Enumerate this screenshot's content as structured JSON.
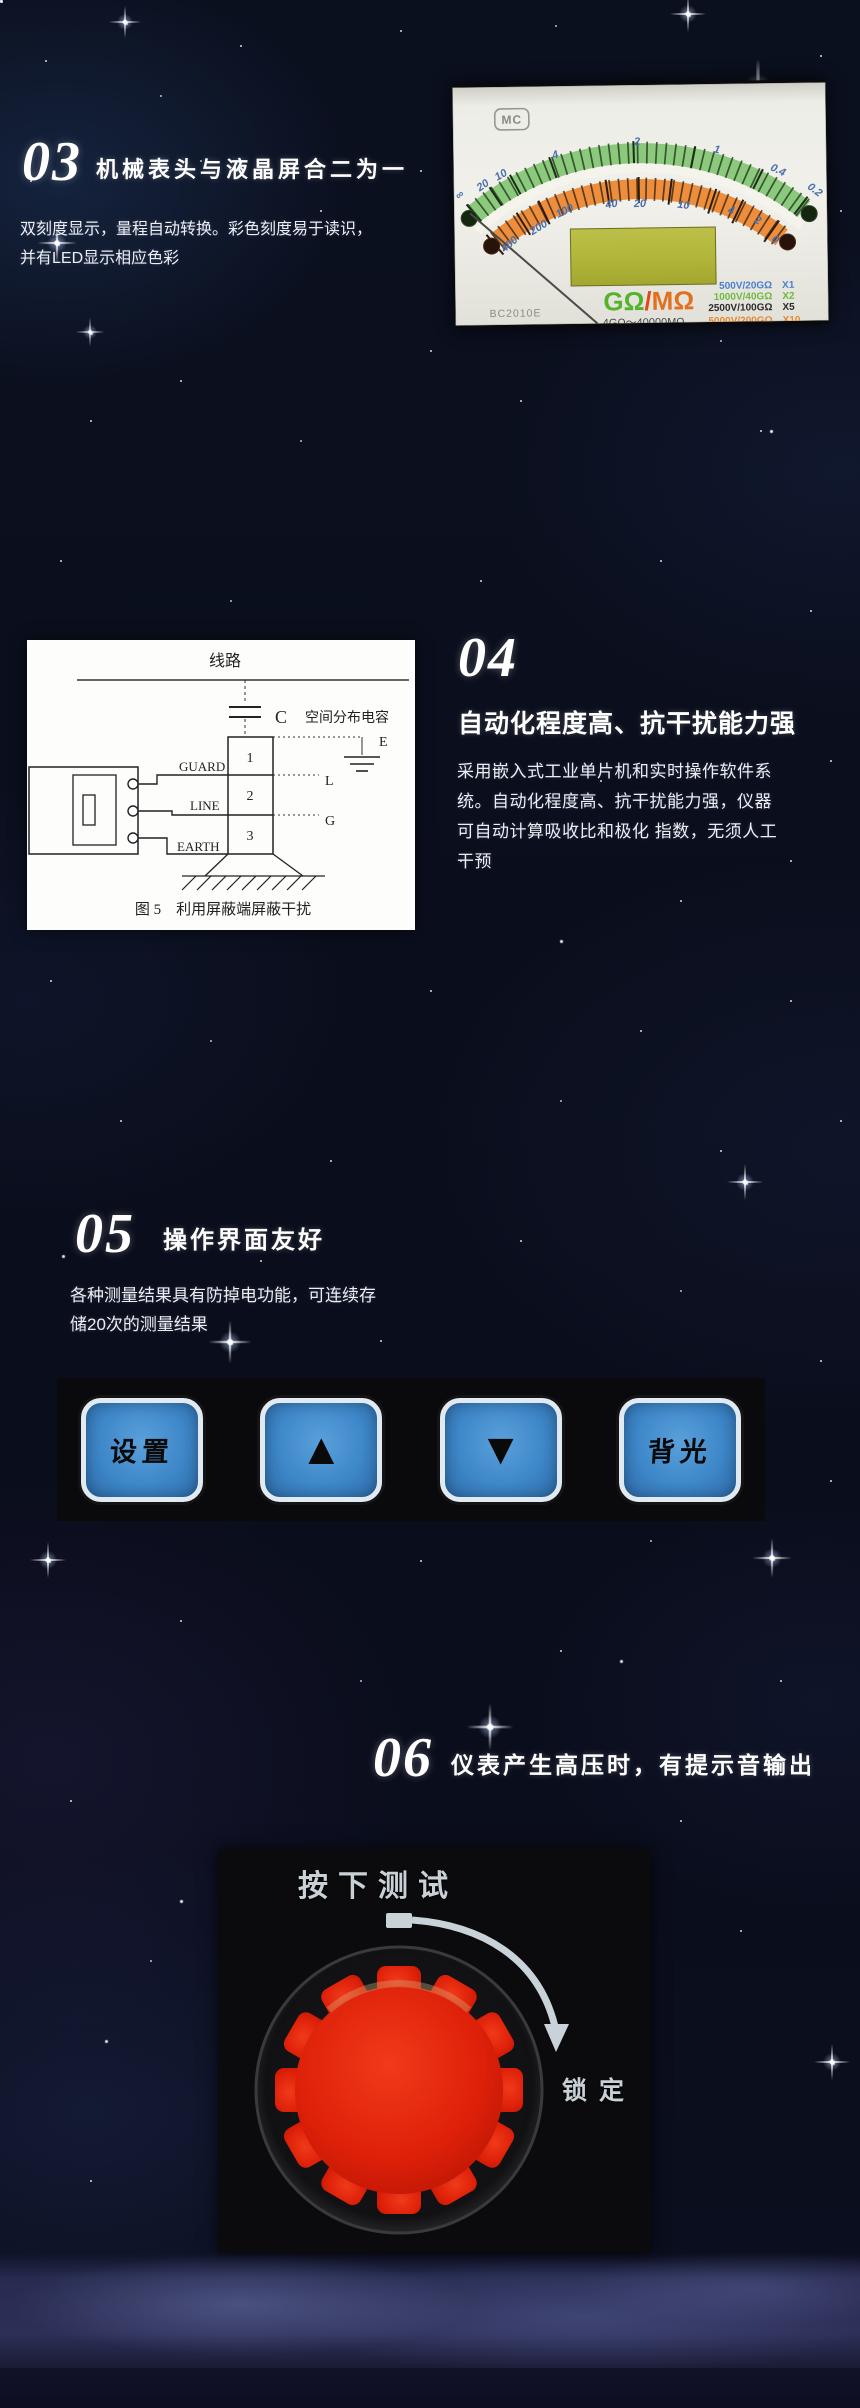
{
  "sections": {
    "s03": {
      "number": "03",
      "title": "机械表头与液晶屏合二为一",
      "body": [
        "双刻度显示，量程自动转换。彩色刻度易于读识，",
        "并有LED显示相应色彩"
      ]
    },
    "s04": {
      "number": "04",
      "title": "自动化程度高、抗干扰能力强",
      "body": [
        "采用嵌入式工业单片机和实时操作软件系",
        "统。自动化程度高、抗干扰能力强，仪器",
        "可自动计算吸收比和极化 指数，无须人工",
        "干预"
      ]
    },
    "s05": {
      "number": "05",
      "title": "操作界面友好",
      "body": [
        "各种测量结果具有防掉电功能，可连续存",
        "储20次的测量结果"
      ]
    },
    "s06": {
      "number": "06",
      "title": "仪表产生高压时，有提示音输出"
    }
  },
  "meter": {
    "brand": "MC",
    "model": "BC2010E",
    "green_scale": [
      "∞",
      "20",
      "10",
      "4",
      "2",
      "1",
      "0.4",
      "0.2"
    ],
    "orange_scale": [
      "400",
      "200",
      "100",
      "40",
      "20",
      "10",
      "4",
      "2",
      "0"
    ],
    "unit_green": "GΩ",
    "unit_divider": "/",
    "unit_orange": "MΩ",
    "range_note": "4GΩ～40000MΩ",
    "ranges": [
      {
        "label": "500V/20GΩ",
        "mult": "X1",
        "color": "#4a7fd0"
      },
      {
        "label": "1000V/40GΩ",
        "mult": "X2",
        "color": "#6db93f"
      },
      {
        "label": "2500V/100GΩ",
        "mult": "X5",
        "color": "#2a2a2a"
      },
      {
        "label": "5000V/200GΩ",
        "mult": "X10",
        "color": "#e8872e"
      }
    ],
    "colors": {
      "green_band": "#8bc97c",
      "orange_band": "#ee8e3d",
      "lcd": "#b5b93c"
    }
  },
  "diagram": {
    "line_label": "线路",
    "cap_symbol": "C",
    "cap_label": "空间分布电容",
    "cell_labels": [
      "1",
      "2",
      "3"
    ],
    "terminal_labels": [
      "GUARD",
      "LINE",
      "EARTH"
    ],
    "right_labels": [
      "E",
      "L",
      "G"
    ],
    "caption": "图 5　利用屏蔽端屏蔽干扰"
  },
  "keypad": {
    "buttons": [
      {
        "label": "设置",
        "kind": "text"
      },
      {
        "label": "▲",
        "kind": "up-arrow"
      },
      {
        "label": "▼",
        "kind": "down-arrow"
      },
      {
        "label": "背光",
        "kind": "text"
      }
    ],
    "button_color": "#3e87c8"
  },
  "knob": {
    "top_label": "按下测试",
    "lock_label": "锁定",
    "knob_color": "#e0250e"
  }
}
